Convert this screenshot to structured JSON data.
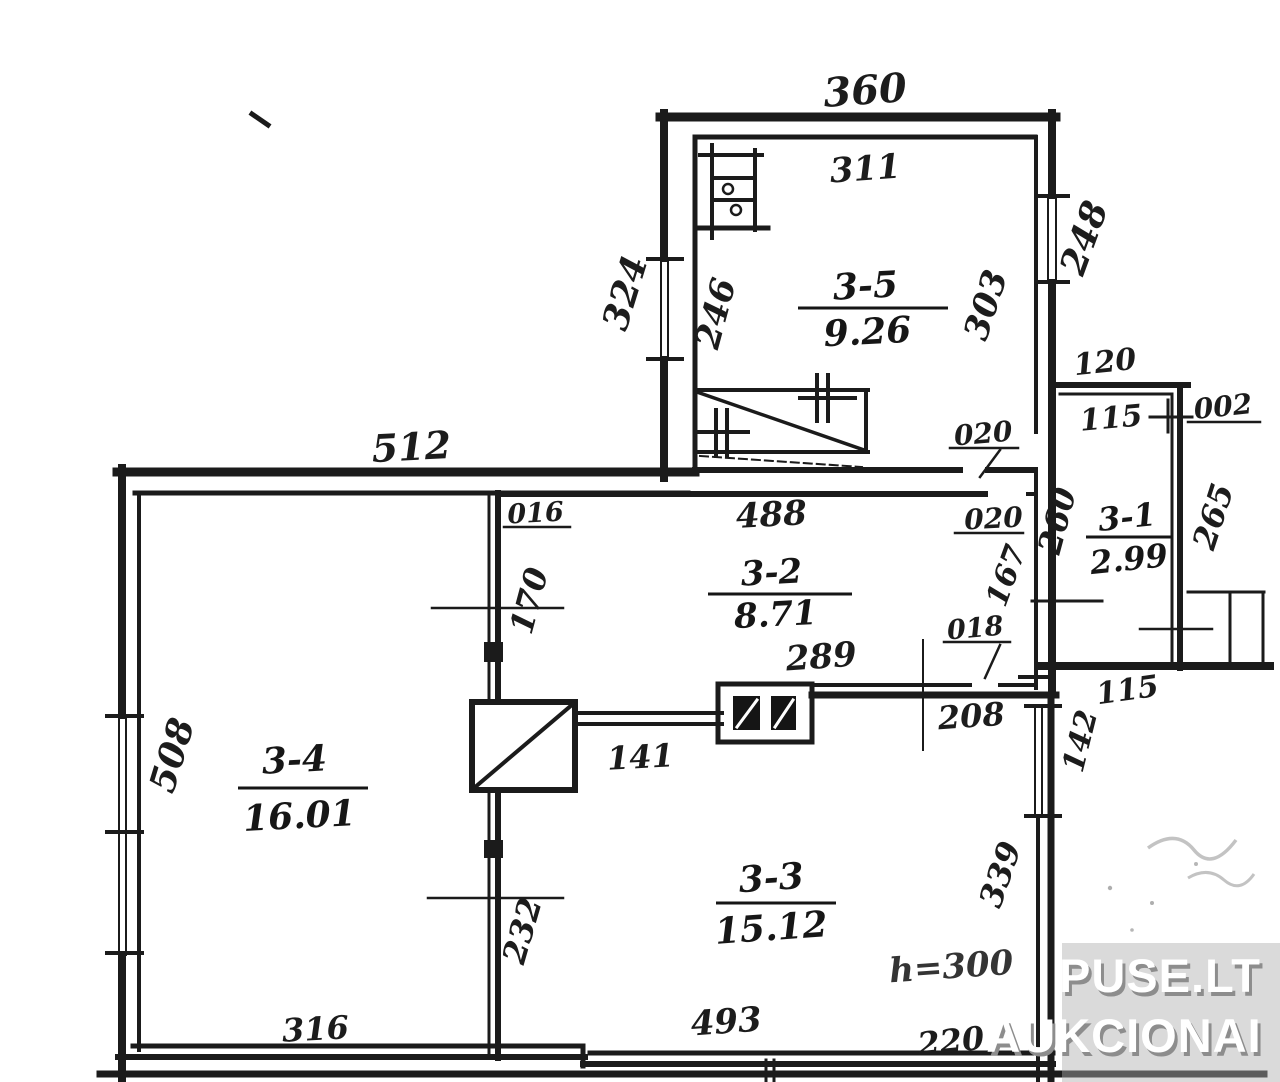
{
  "watermark": {
    "line1": "PUSE.LT",
    "line2": "AUKCIONAI"
  },
  "rooms": {
    "r35": {
      "id": "3-5",
      "area": "9.26"
    },
    "r32": {
      "id": "3-2",
      "area": "8.71"
    },
    "r31": {
      "id": "3-1",
      "area": "2.99"
    },
    "r34": {
      "id": "3-4",
      "area": "16.01"
    },
    "r33": {
      "id": "3-3",
      "area": "15.12"
    }
  },
  "dims": {
    "d360": "360",
    "d311": "311",
    "d324": "324",
    "d246": "246",
    "d303": "303",
    "d248": "248",
    "d120": "120",
    "d115a": "115",
    "d002": "002",
    "d260": "260",
    "d265": "265",
    "d115b": "115",
    "d512": "512",
    "d016": "016",
    "d488": "488",
    "d020a": "020",
    "d020b": "020",
    "d170": "170",
    "d167": "167",
    "d289": "289",
    "d018": "018",
    "d208": "208",
    "d142": "142",
    "d141": "141",
    "d508": "508",
    "d232": "232",
    "d339": "339",
    "d316": "316",
    "d493": "493",
    "d220": "220",
    "height_note": "h=300"
  },
  "colors": {
    "ink": "#1b1b1b",
    "watermark_bg": "#adadad",
    "faint": "#b5b5b5"
  }
}
